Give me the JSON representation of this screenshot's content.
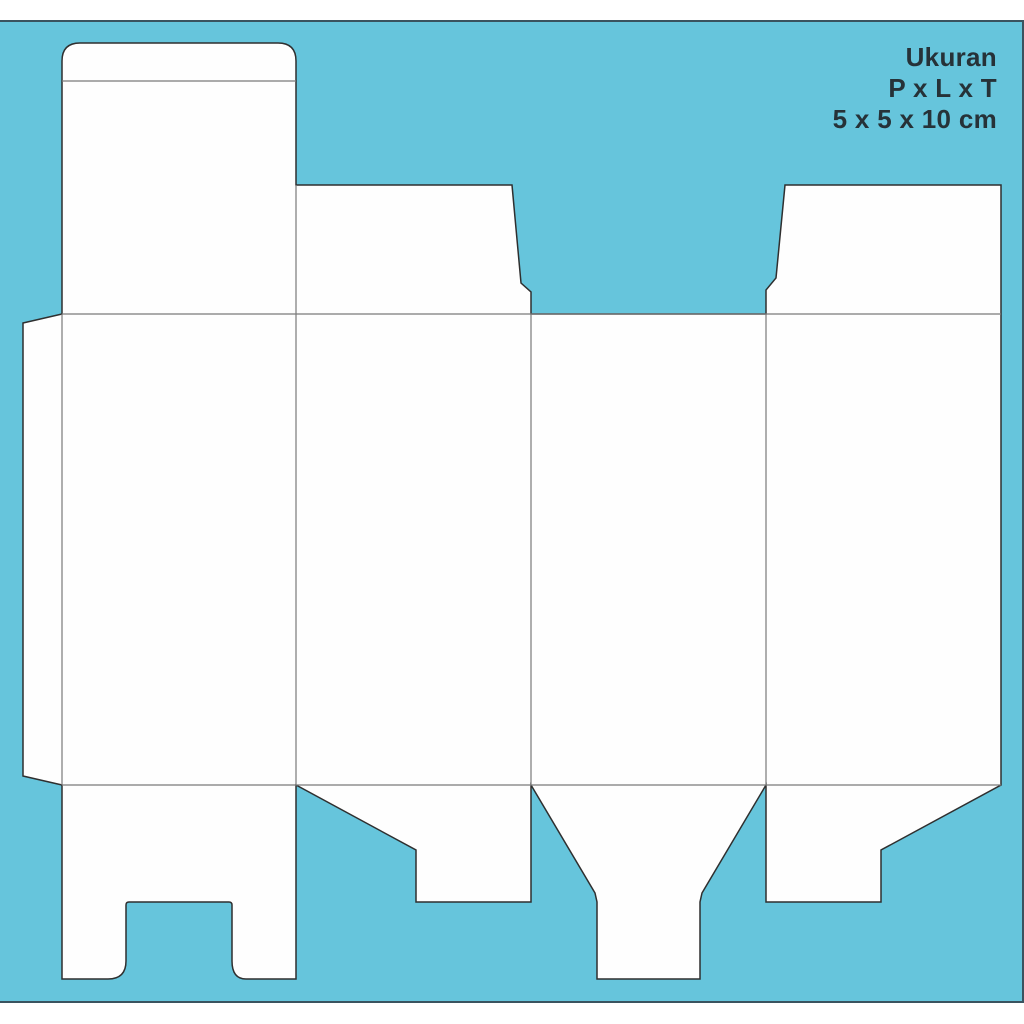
{
  "info_block": {
    "title": "Ukuran",
    "dimension_label": "P x L x T",
    "dimension_value": "5 x 5 x 10 cm"
  },
  "colors": {
    "page_background": "#FFFFFF",
    "artboard_blue": "#66C5DC",
    "artboard_border": "#3A535F",
    "dieline_fill": "#FEFEFE",
    "cut_line": "#2F2F2F",
    "fold_line": "#7A7A7A",
    "text": "#263238"
  }
}
